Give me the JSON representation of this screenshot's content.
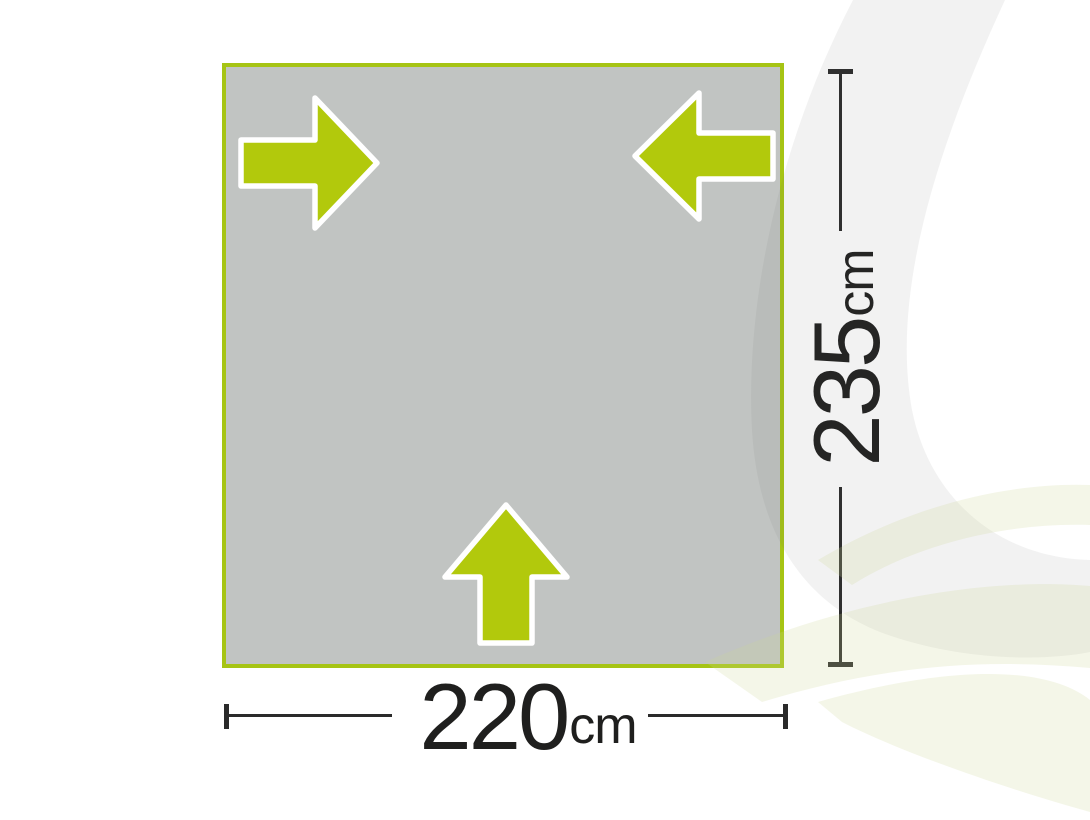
{
  "diagram": {
    "kind": "groundsheet-dimension-diagram",
    "shape_fill": "#c1c4c2",
    "shape_border_color": "#a6c414",
    "arrow_color": "#b2c90c",
    "arrow_outline_color": "#ffffff",
    "arrows": [
      "right",
      "left",
      "up"
    ],
    "width_label": {
      "value": "220",
      "unit": "cm"
    },
    "height_label": {
      "value": "235",
      "unit": "cm"
    },
    "dimension_line_color": "#2a2a2a",
    "label_text_color": "#1f1f1e"
  },
  "decor": {
    "ring_color": "#ededed",
    "wave_color": "#f2f4e4"
  }
}
